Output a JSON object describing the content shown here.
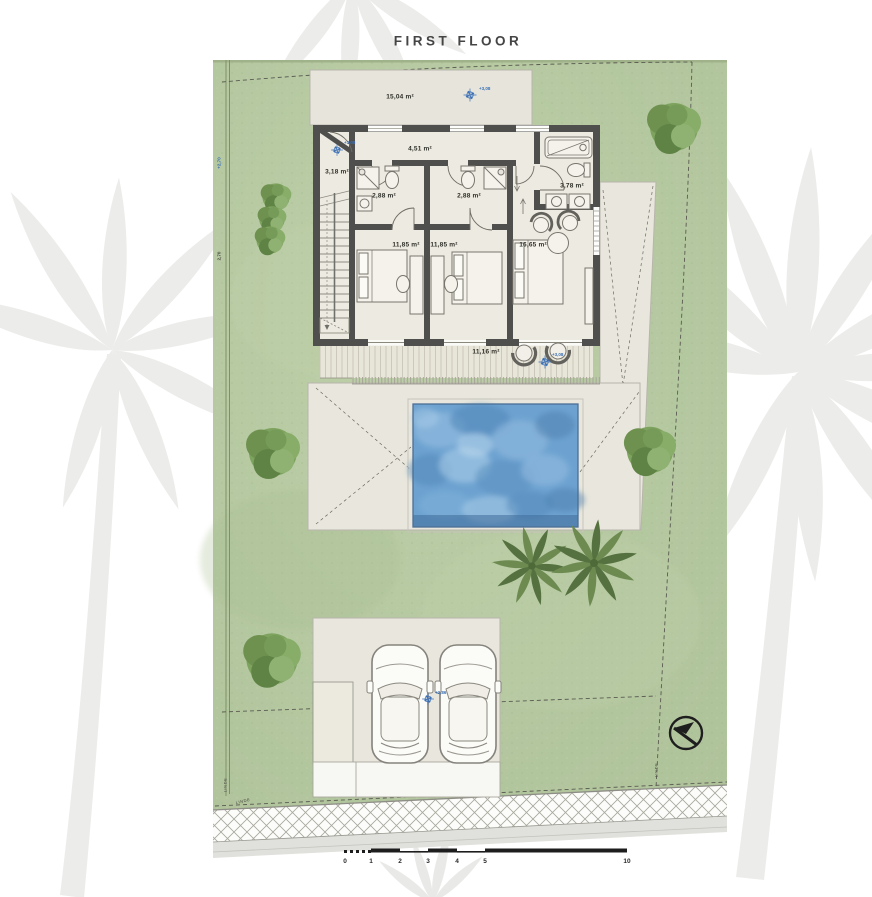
{
  "title": "FIRST FLOOR",
  "plan": {
    "rooms": [
      {
        "id": "upper-terrace",
        "area": "15,04 m²"
      },
      {
        "id": "entry",
        "area": "3,18 m²"
      },
      {
        "id": "hallway",
        "area": "4,51 m²"
      },
      {
        "id": "bathroom-1",
        "area": "2,88 m²"
      },
      {
        "id": "bathroom-2",
        "area": "2,88 m²"
      },
      {
        "id": "bathroom-3",
        "area": "3,78 m²"
      },
      {
        "id": "bedroom-1",
        "area": "11,85 m²"
      },
      {
        "id": "bedroom-2",
        "area": "11,85 m²"
      },
      {
        "id": "master-bedroom",
        "area": "16,65 m²"
      },
      {
        "id": "rear-deck",
        "area": "11,16 m²"
      }
    ],
    "level_markers": [
      {
        "id": "upper-terrace",
        "value": "+3,08"
      },
      {
        "id": "entry",
        "value": "+3,08"
      },
      {
        "id": "rear-deck",
        "value": "+3,08"
      },
      {
        "id": "parking",
        "value": "+2,86"
      }
    ],
    "boundary_label": "LINDE",
    "edge_measurements": [
      "+2,70",
      "2,70"
    ]
  },
  "scale_bar": {
    "labels": [
      "0",
      "1",
      "2",
      "3",
      "4",
      "5",
      "10"
    ]
  },
  "icons": [
    "north-arrow-icon",
    "level-marker-icon",
    "palm-tree",
    "tree",
    "car"
  ],
  "colors": {
    "lawn": "#b6c8a1",
    "terrace": "#e9e7dd",
    "wall": "#4f4f4d",
    "pool_water": "#6da2d0",
    "marker_blue": "#3a6fb5",
    "watermark": "#ececea"
  }
}
